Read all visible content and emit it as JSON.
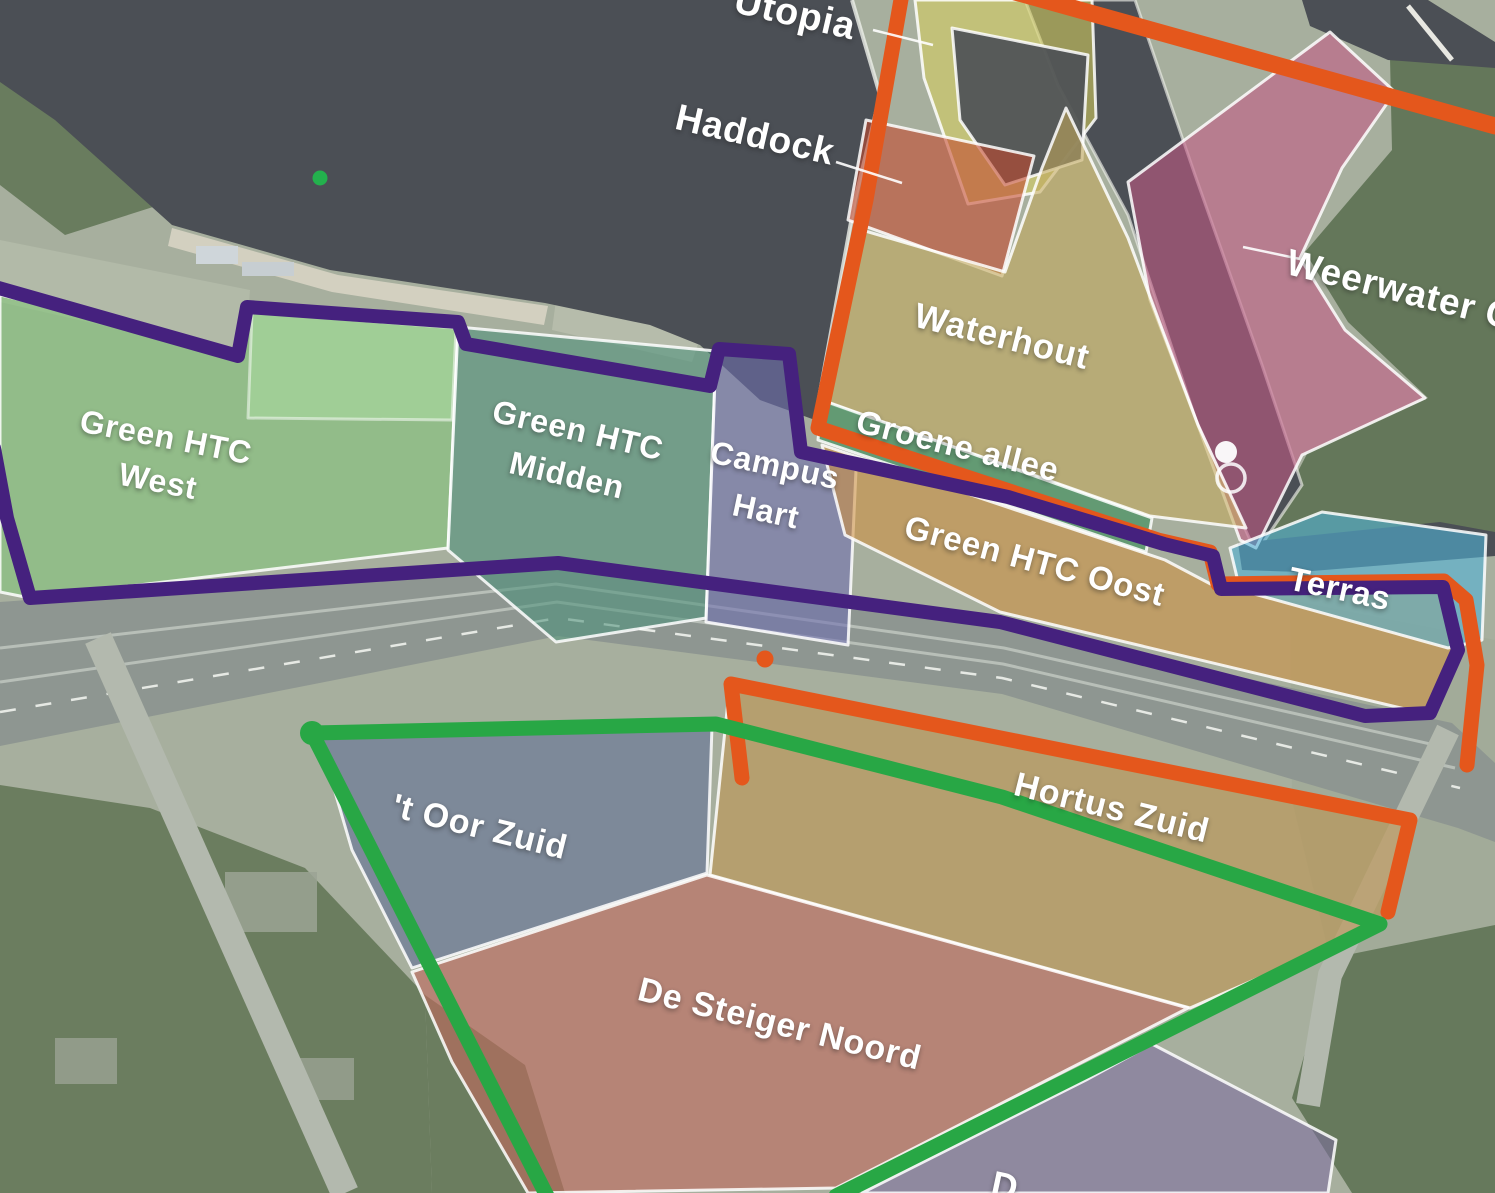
{
  "map_labels": {
    "utopia": "Utopia",
    "haddock": "Haddock",
    "weerwater_partial": "Weerwater C",
    "waterhout": "Waterhout",
    "groene_allee": "Groene allee",
    "green_htc_west_line1": "Green HTC",
    "green_htc_west_line2": "West",
    "green_htc_midden_line1": "Green HTC",
    "green_htc_midden_line2": "Midden",
    "campus_hart_line1": "Campus",
    "campus_hart_line2": "Hart",
    "green_htc_oost": "Green HTC Oost",
    "terras": "Terras",
    "t_oor_zuid": "'t Oor Zuid",
    "hortus_zuid": "Hortus Zuid",
    "de_steiger_noord": "De Steiger Noord",
    "bottom_partial": "D"
  },
  "zone_colors": {
    "utopia": "#d5ce5f",
    "red_north": "#c4492c",
    "weerwater": "#c25a85",
    "waterhout": "#c2a85c",
    "groene_allee": "#3f8f5c",
    "green_htc_west": "#83c77b",
    "green_htc_west_inner": "#aadaa0",
    "green_htc_midden": "#4e917b",
    "campus_hart": "#6e6eb0",
    "green_htc_oost": "#ce9040",
    "terras": "#4fb3d9",
    "t_oor_zuid": "#5e6f96",
    "hortus_zuid": "#c19045",
    "de_steiger_noord": "#c06b5e",
    "bottom_purple": "#7d6fa0"
  },
  "boundary_lines": {
    "purple": "#45217e",
    "orange": "#e4571c",
    "green": "#28a745"
  },
  "markers": {
    "green_dot_water": "#23b14d",
    "orange_dot": "#e4571c",
    "green_dot_corner": "#28a745",
    "person_marker": "#ffffff"
  },
  "terrain_colors": {
    "land": "#a7af9e",
    "forest": "#697c5e",
    "water": "#4b4f55",
    "beach": "#d7d3c3",
    "highway": "#8e9691",
    "road": "#b3b9ae"
  }
}
